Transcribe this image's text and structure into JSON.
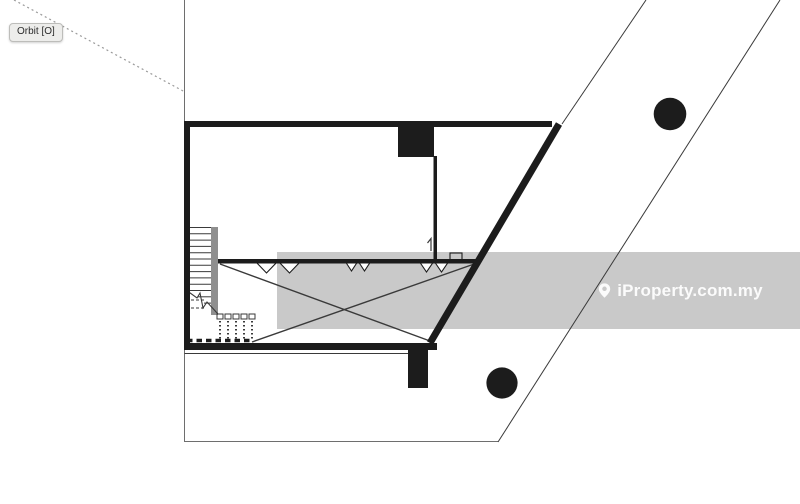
{
  "viewer": {
    "tooltip_label": "Orbit [O]"
  },
  "watermark": {
    "text": "iProperty.com.my",
    "icon": "location-pin-icon"
  },
  "colors": {
    "ink": "#1c1c1c",
    "thin_line": "#3a3a3a",
    "boundary_line": "#6e6e6e",
    "dotted_line": "#9a9a9a",
    "watermark_band": "#c9c9c9",
    "stair_strip": "#8f8f8f",
    "tooltip_bg": "#ededeb",
    "watermark_text": "#fbfbfb"
  }
}
